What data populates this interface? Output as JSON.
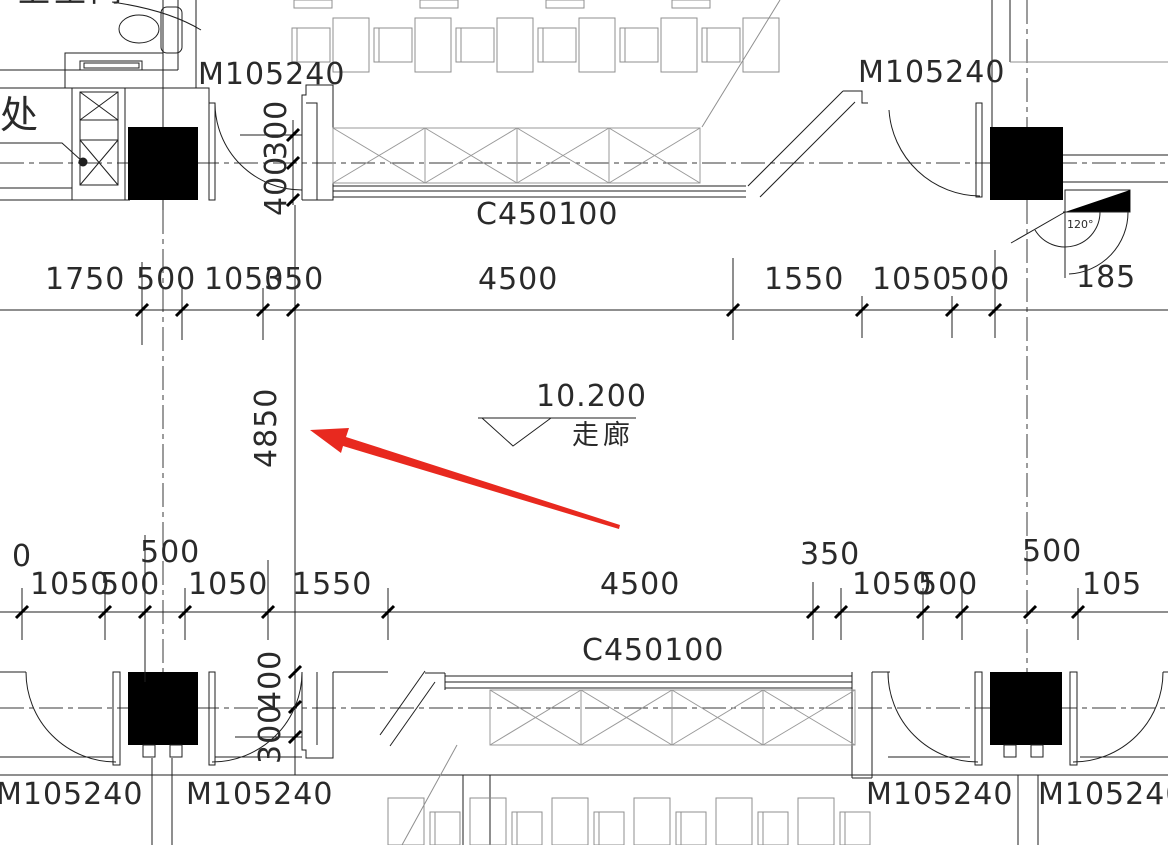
{
  "labels": {
    "toilet_room": "卫生间",
    "chu": "处",
    "door_top_left": "M105240",
    "door_top_right": "M105240",
    "window_top": "C450100",
    "window_bottom": "C450100",
    "door_bottom_1": "M105240",
    "door_bottom_2": "M105240",
    "door_bottom_3": "M105240",
    "door_bottom_4": "M105240",
    "angle": "120°"
  },
  "elevation": {
    "value": "10.200",
    "room": "走廊"
  },
  "dims": {
    "top_row": [
      "1750",
      "500",
      "1050",
      "350",
      "4500",
      "1550",
      "1050",
      "500",
      "185"
    ],
    "bottom_row": [
      "0",
      "1050",
      "500",
      "1050",
      "1550",
      "4500",
      "1050",
      "500",
      "105"
    ],
    "bottom_upper": [
      "500",
      "350",
      "500"
    ],
    "vertical_corridor": "4850",
    "top_wall": [
      "300",
      "400"
    ],
    "bottom_wall": [
      "400",
      "300"
    ]
  },
  "colors": {
    "line": "#1f1f1f",
    "furniture_gray": "#8f8f8f",
    "arrow_red": "#e8291f"
  }
}
